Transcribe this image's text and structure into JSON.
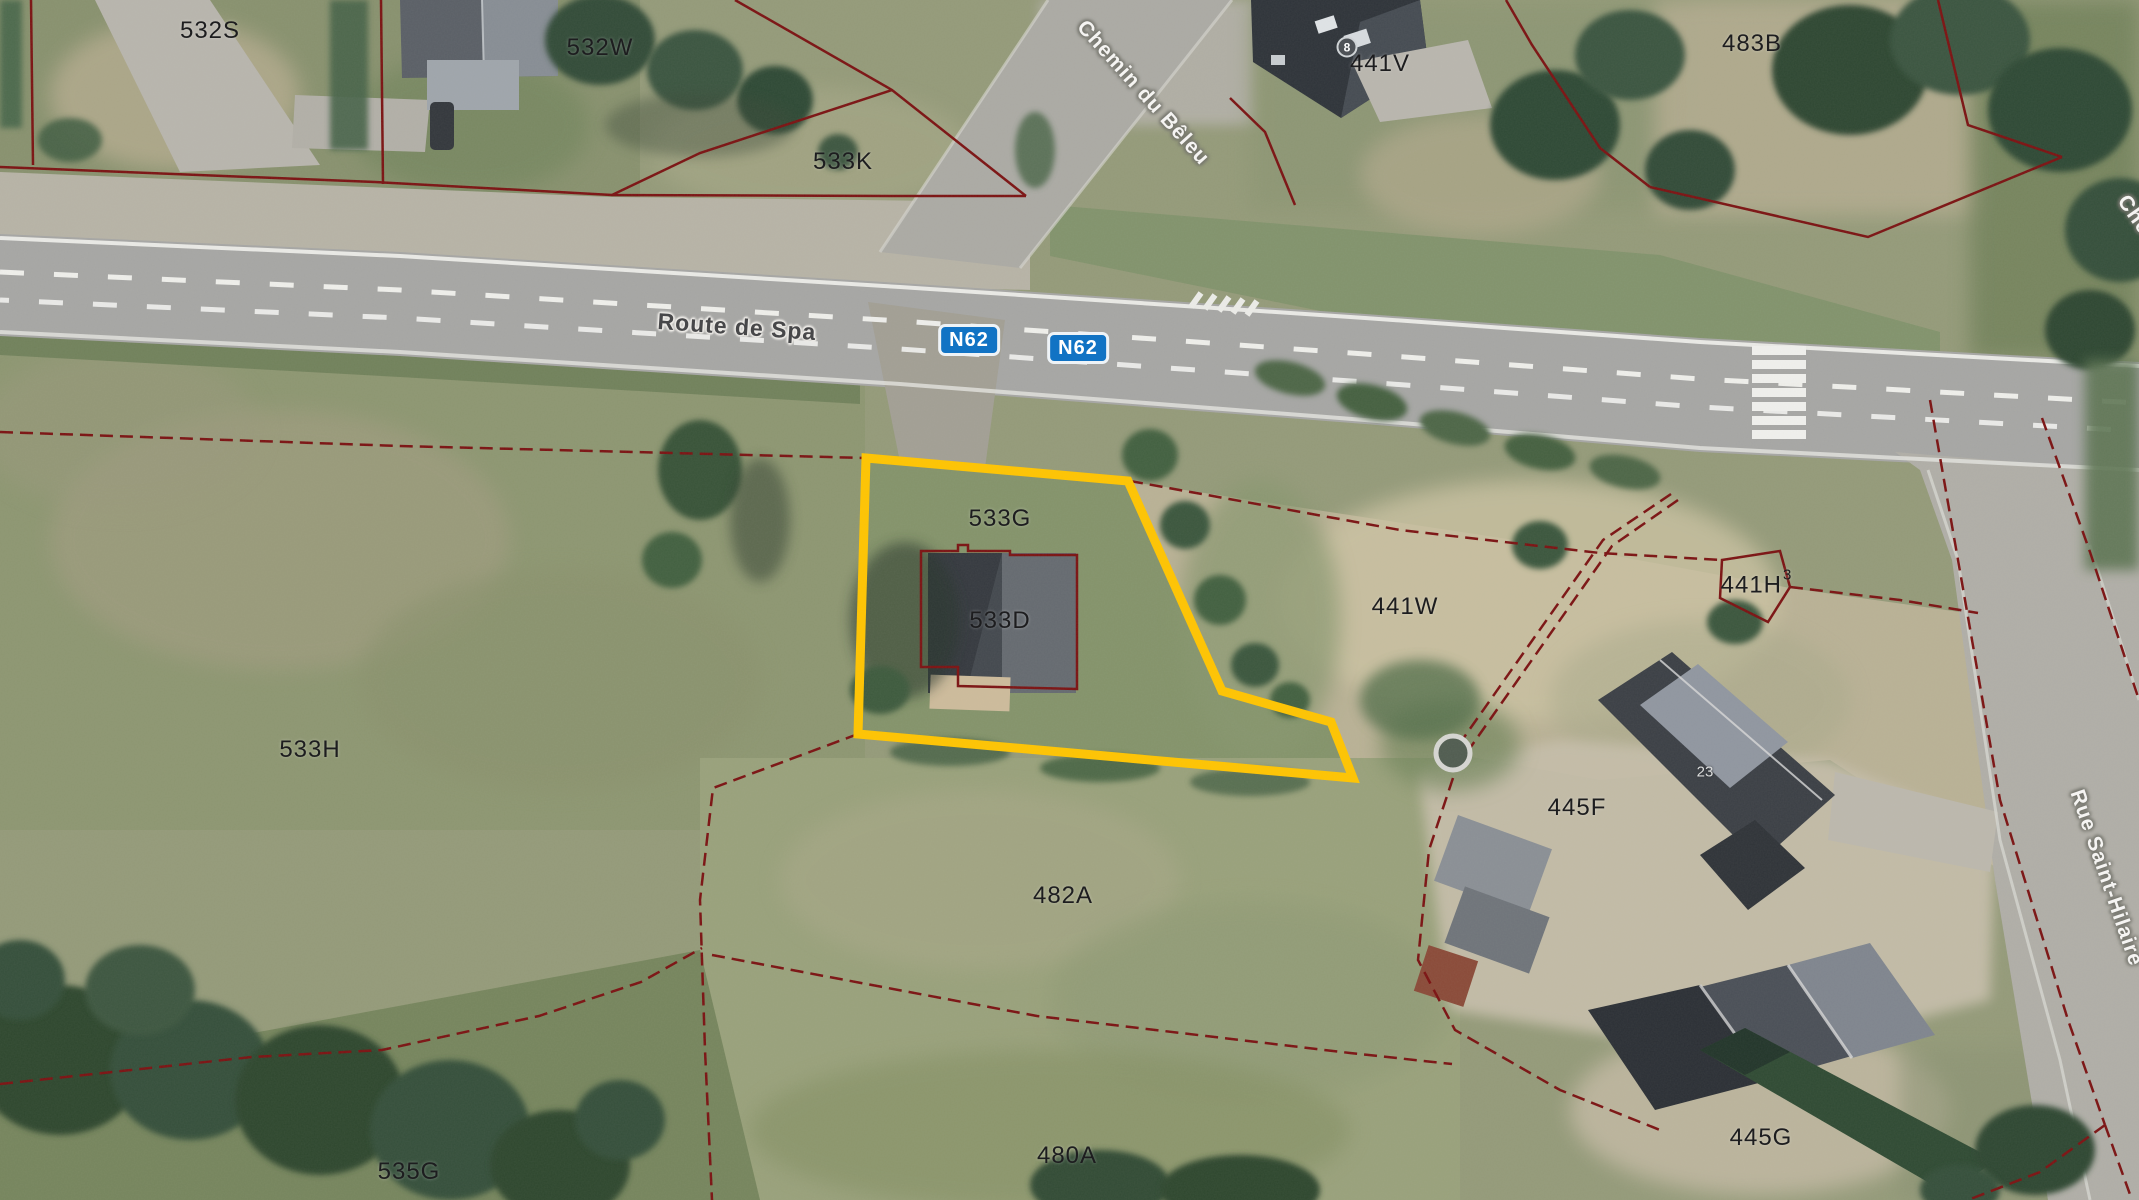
{
  "map": {
    "kind": "cadastral-parcel-viewer-aerial",
    "highlight_color": "#ffc400",
    "parcel_line_color": "#7b1212",
    "route_badge_color": "#1173c4"
  },
  "parcel_labels": [
    {
      "text": "532S"
    },
    {
      "text": "532W"
    },
    {
      "text": "533K"
    },
    {
      "text": "483B"
    },
    {
      "text": "441V"
    },
    {
      "text": "533G"
    },
    {
      "text": "533D"
    },
    {
      "text": "441W"
    },
    {
      "text": "533H"
    },
    {
      "text": "482A"
    },
    {
      "text": "480A"
    },
    {
      "text": "535G"
    },
    {
      "text": "445F"
    },
    {
      "text": "445G"
    }
  ],
  "parcel_441h": {
    "text": "441H",
    "superscript": "3"
  },
  "road_labels": {
    "main": "Route de Spa",
    "side_top": "Chemin du Bêleu",
    "side_right": "Rue Saint-Hilaire",
    "side_partial": "Che"
  },
  "route_badges": [
    {
      "text": "N62"
    },
    {
      "text": "N62"
    }
  ],
  "house_numbers": [
    {
      "text": "8"
    },
    {
      "text": "23"
    }
  ]
}
